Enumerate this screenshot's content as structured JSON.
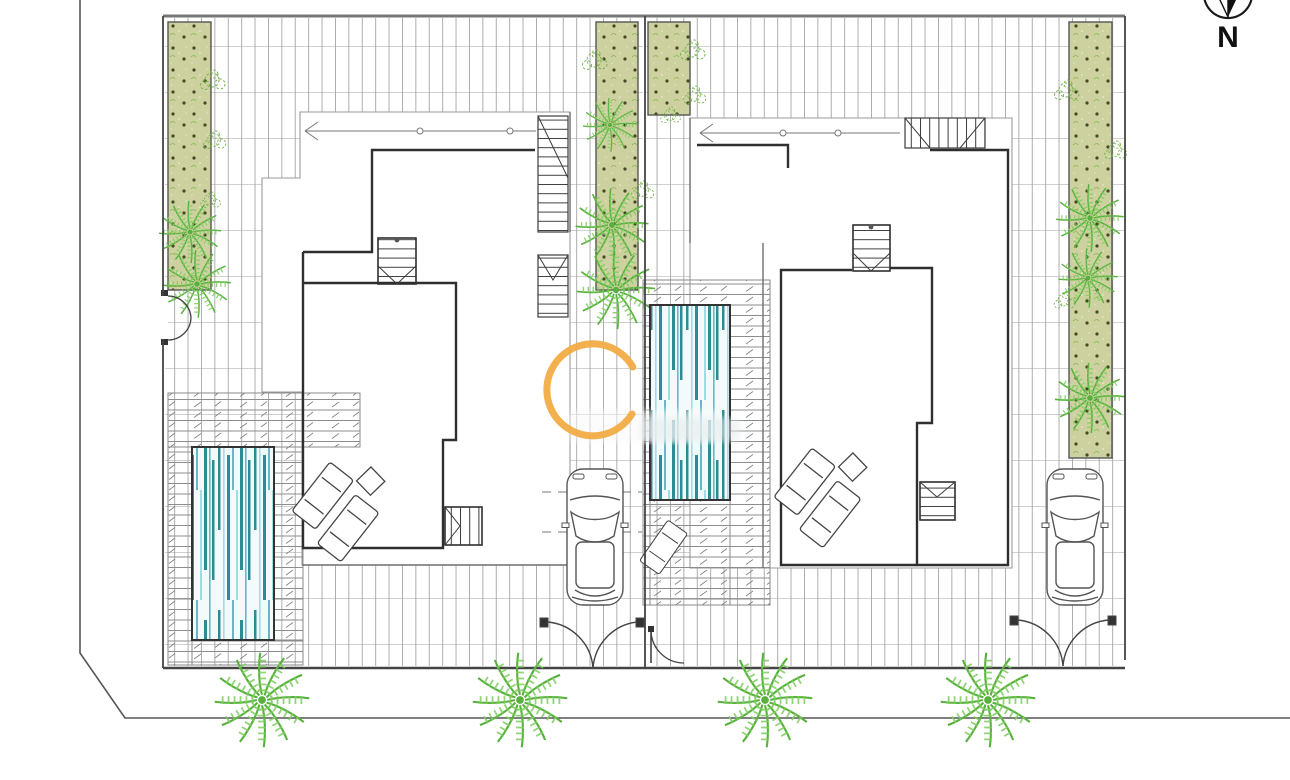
{
  "document": {
    "type": "architectural-site-plan",
    "description": "Top view site plan of two mirrored detached villas with private pools, wood decks, tiled courtyards, parked cars, planting strips and street palm trees"
  },
  "compass": {
    "label": "N"
  },
  "watermark": {
    "shape": "orange-arc-logo",
    "color": "#F2A93F"
  },
  "palette": {
    "background": "#FFFFFF",
    "wall_dark": "#2F2F2F",
    "line_gray": "#8E8E8E",
    "tile_line": "#A0A0A0",
    "pool_dark_stripe": "#2E8B94",
    "pool_mid_stripe": "#66B9C2",
    "pool_light_stripe": "#9FDDE2",
    "pool_bg": "#F3FAFB",
    "planting_fill": "#CDD1A0",
    "planting_dot": "#434B22",
    "plant_green": "#57B13C",
    "plant_green_light": "#7CCD5E",
    "watermark_orange": "#F2A93F",
    "street_line": "#555555"
  },
  "site": {
    "street_palm_count": 4,
    "plots": [
      {
        "id": "villa-left",
        "position": "west-plot",
        "features": [
          "house",
          "pool",
          "wood-deck",
          "planting-strip",
          "parked-car",
          "driveway-gate",
          "pedestrian-gate",
          "sun-loungers",
          "interior-stair",
          "exterior-stair"
        ]
      },
      {
        "id": "villa-right",
        "position": "east-plot",
        "features": [
          "house",
          "pool",
          "wood-deck",
          "planting-strip",
          "parked-car",
          "driveway-gate",
          "pedestrian-gate",
          "sun-loungers",
          "interior-stair",
          "exterior-stair"
        ]
      }
    ]
  }
}
